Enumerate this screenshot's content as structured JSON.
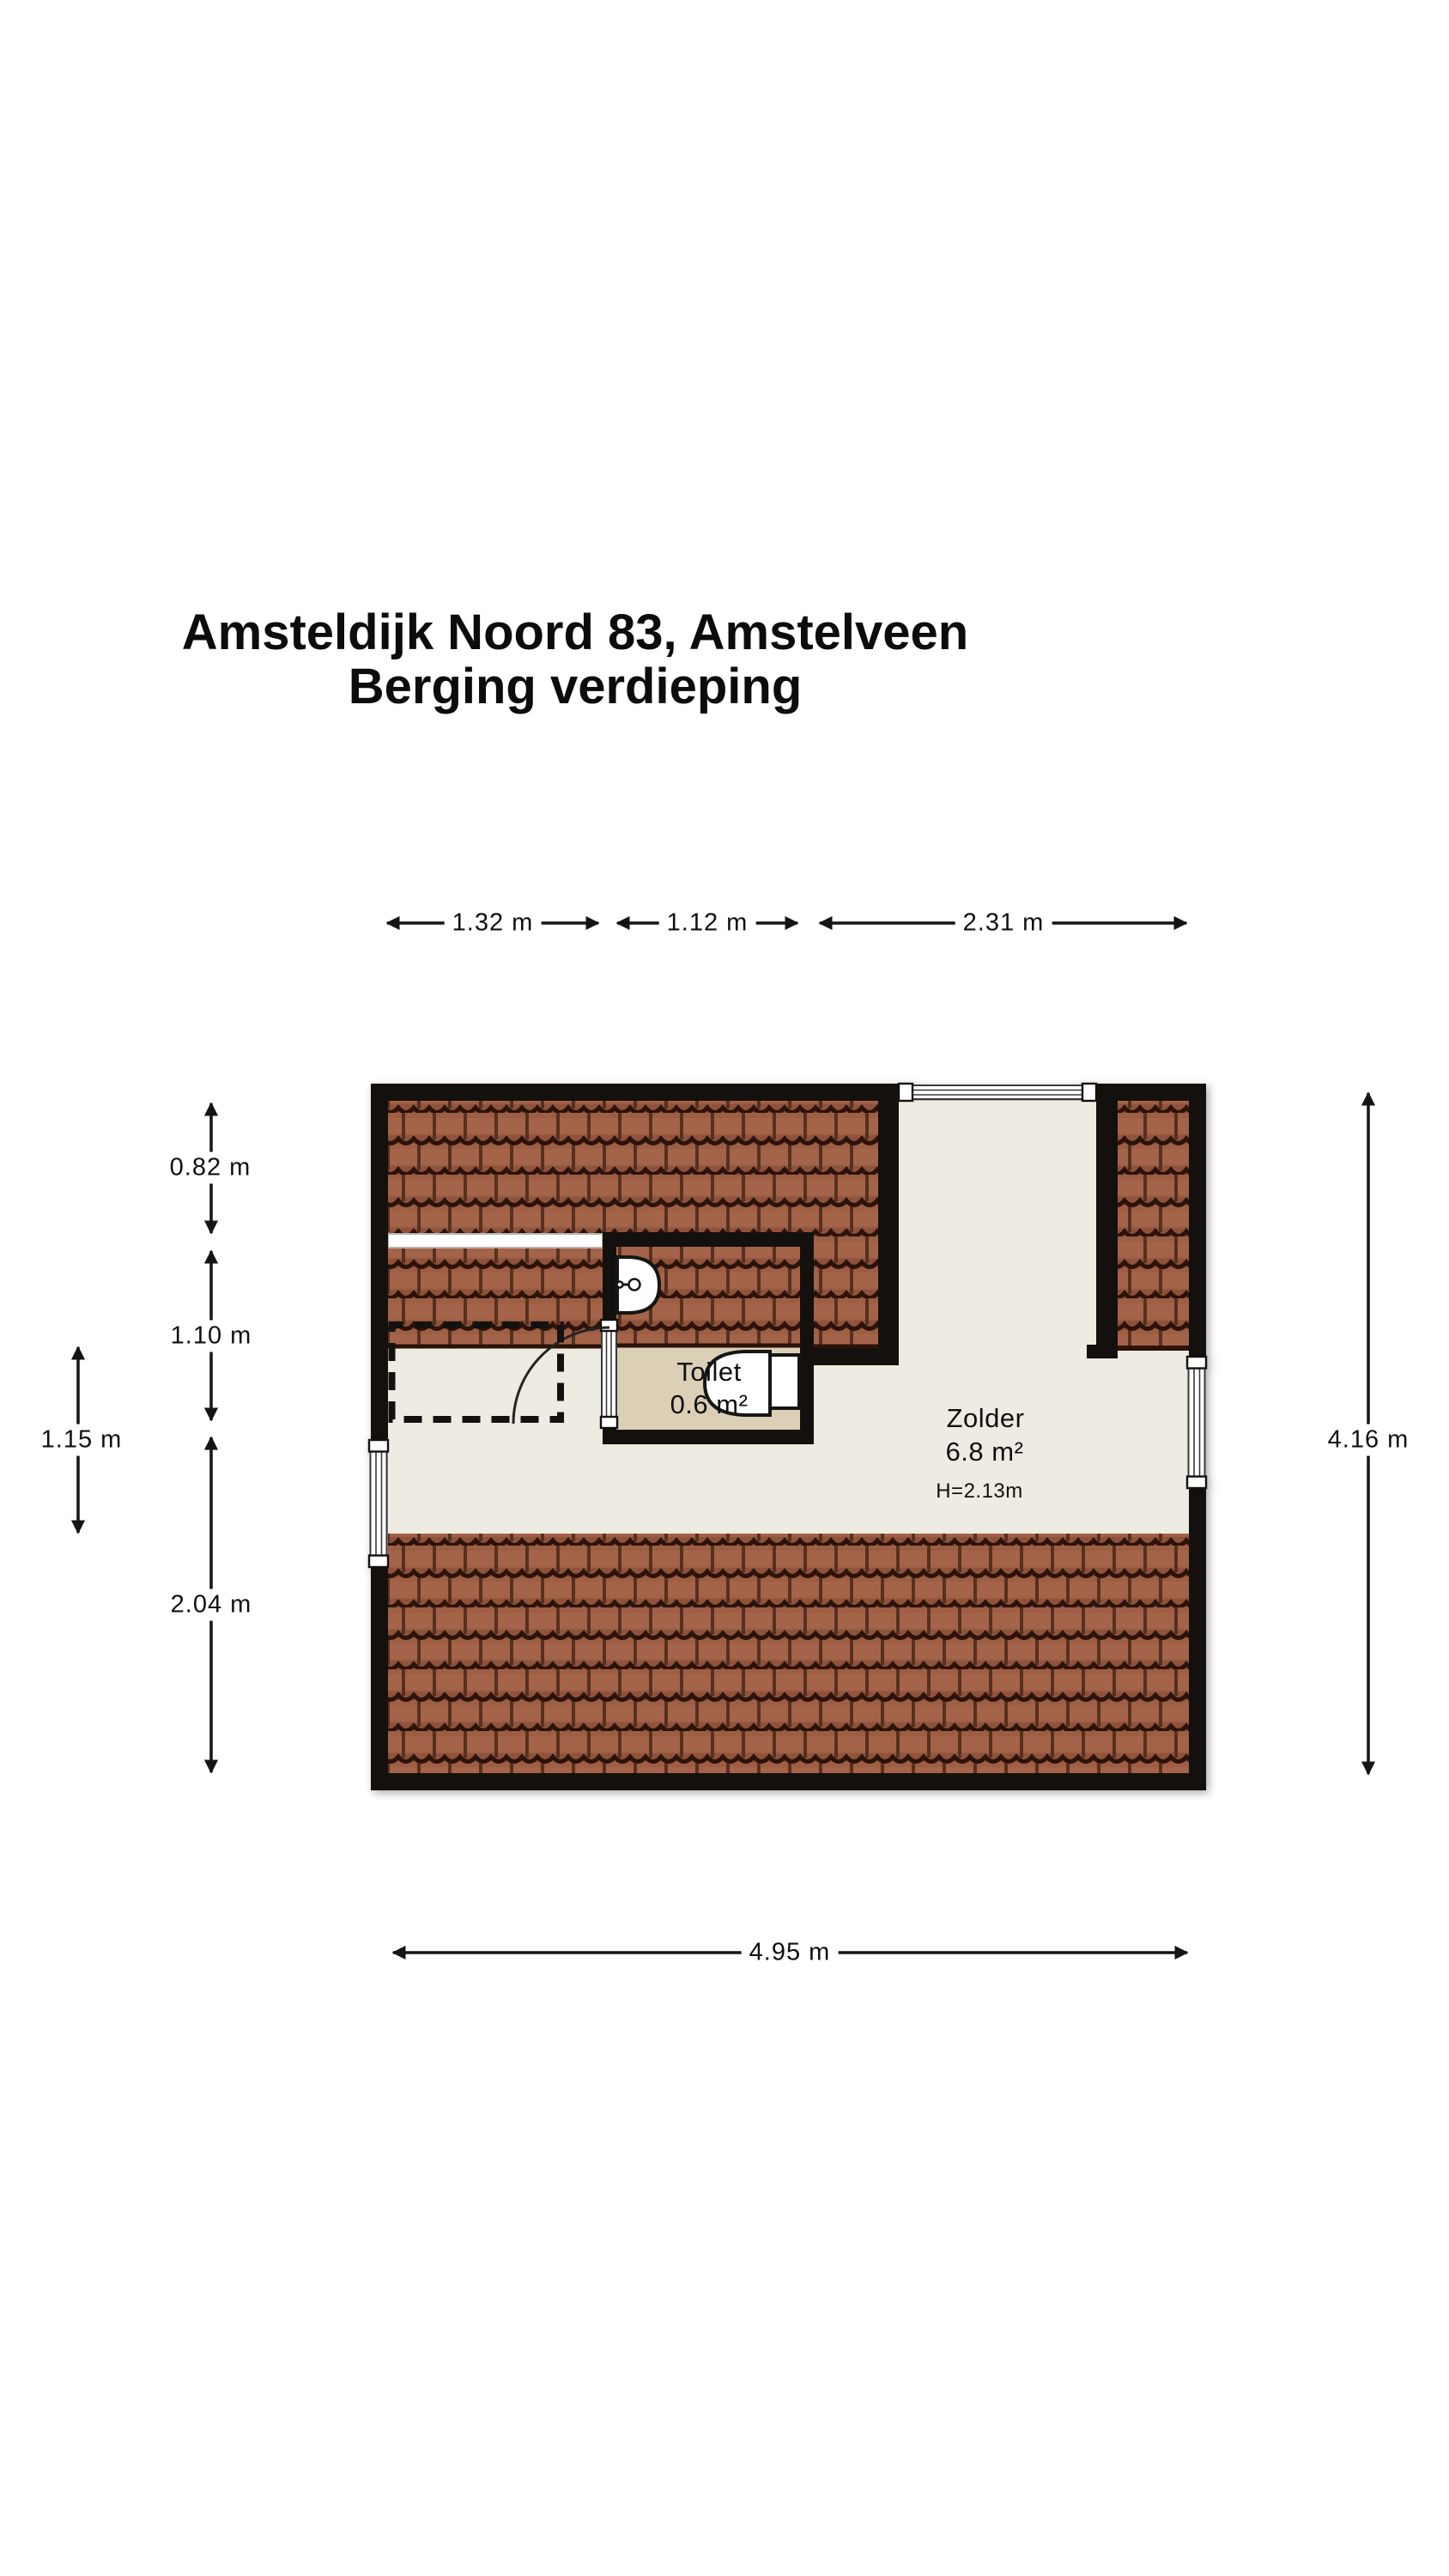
{
  "title": {
    "line1": "Amsteldijk Noord 83, Amstelveen",
    "line2": "Berging verdieping"
  },
  "rooms": {
    "toilet": {
      "name": "Toilet",
      "area": "0.6 m²"
    },
    "zolder": {
      "name": "Zolder",
      "area": "6.8 m²",
      "height": "H=2.13m"
    }
  },
  "dimensions": {
    "top": [
      "1.32 m",
      "1.12 m",
      "2.31 m"
    ],
    "left": [
      "0.82 m",
      "1.10 m",
      "2.04 m"
    ],
    "left_inner": "1.15 m",
    "right": "4.16 m",
    "bottom": "4.95 m"
  },
  "colors": {
    "wall": "#14100d",
    "roof_tile": "#9e5e44",
    "roof_tile_dark": "#2b1309",
    "floor": "#eeebe2",
    "toilet_floor": "#dbcfb6",
    "dimension_line": "#141414"
  }
}
